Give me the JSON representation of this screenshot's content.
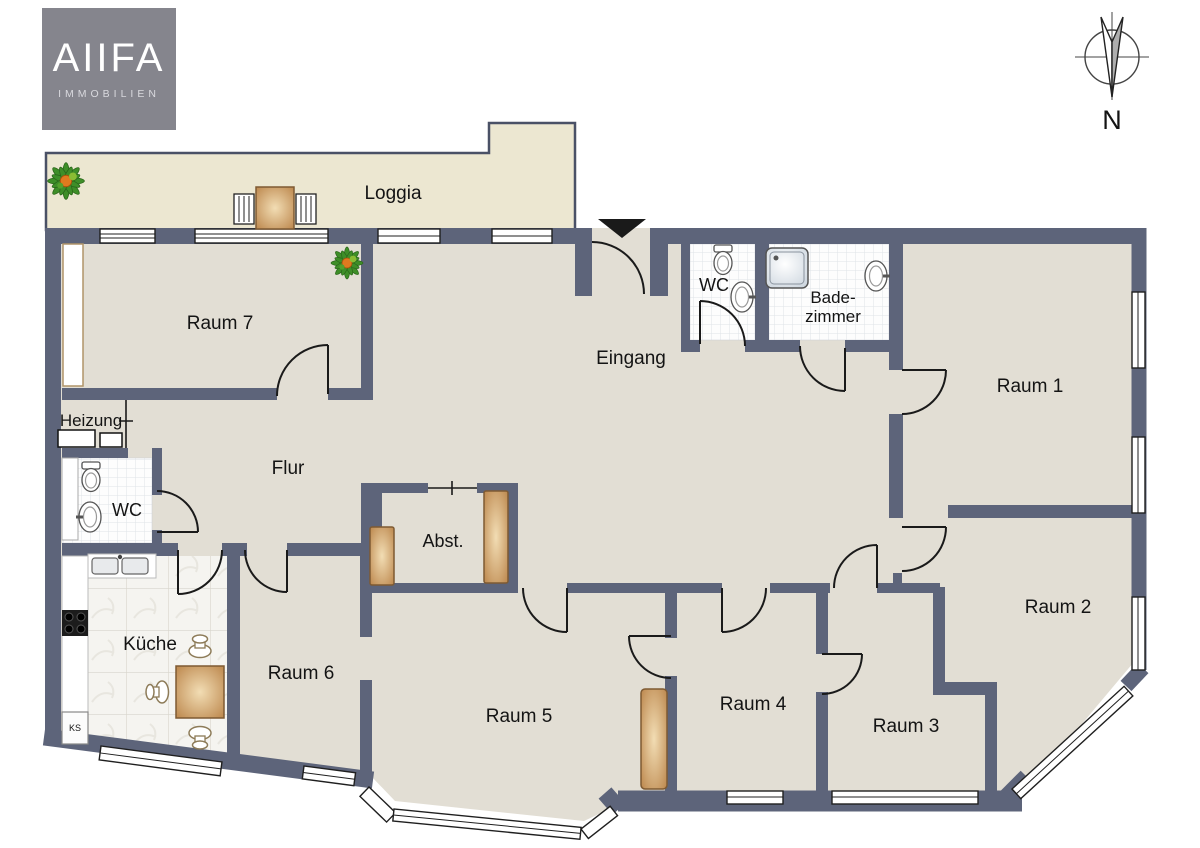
{
  "logo": {
    "title": "AIIFA",
    "subtitle": "IMMOBILIEN"
  },
  "compass": {
    "label": "N"
  },
  "rooms": {
    "loggia": "Loggia",
    "raum7": "Raum 7",
    "eingang": "Eingang",
    "wc_top": "WC",
    "badezimmer_line1": "Bade-",
    "badezimmer_line2": "zimmer",
    "raum1": "Raum 1",
    "heizung": "Heizung",
    "flur": "Flur",
    "wc_left": "WC",
    "abst": "Abst.",
    "kueche": "Küche",
    "raum6": "Raum 6",
    "raum5": "Raum 5",
    "raum4": "Raum 4",
    "raum3": "Raum 3",
    "raum2": "Raum 2",
    "ks": "KS"
  },
  "colors": {
    "wall": "#5d647a",
    "floor": "#e2ded4",
    "loggia_floor": "#ece7d1",
    "logo_bg": "#85858d",
    "tile": "#fdfdfd",
    "wood": "#c89a62"
  }
}
